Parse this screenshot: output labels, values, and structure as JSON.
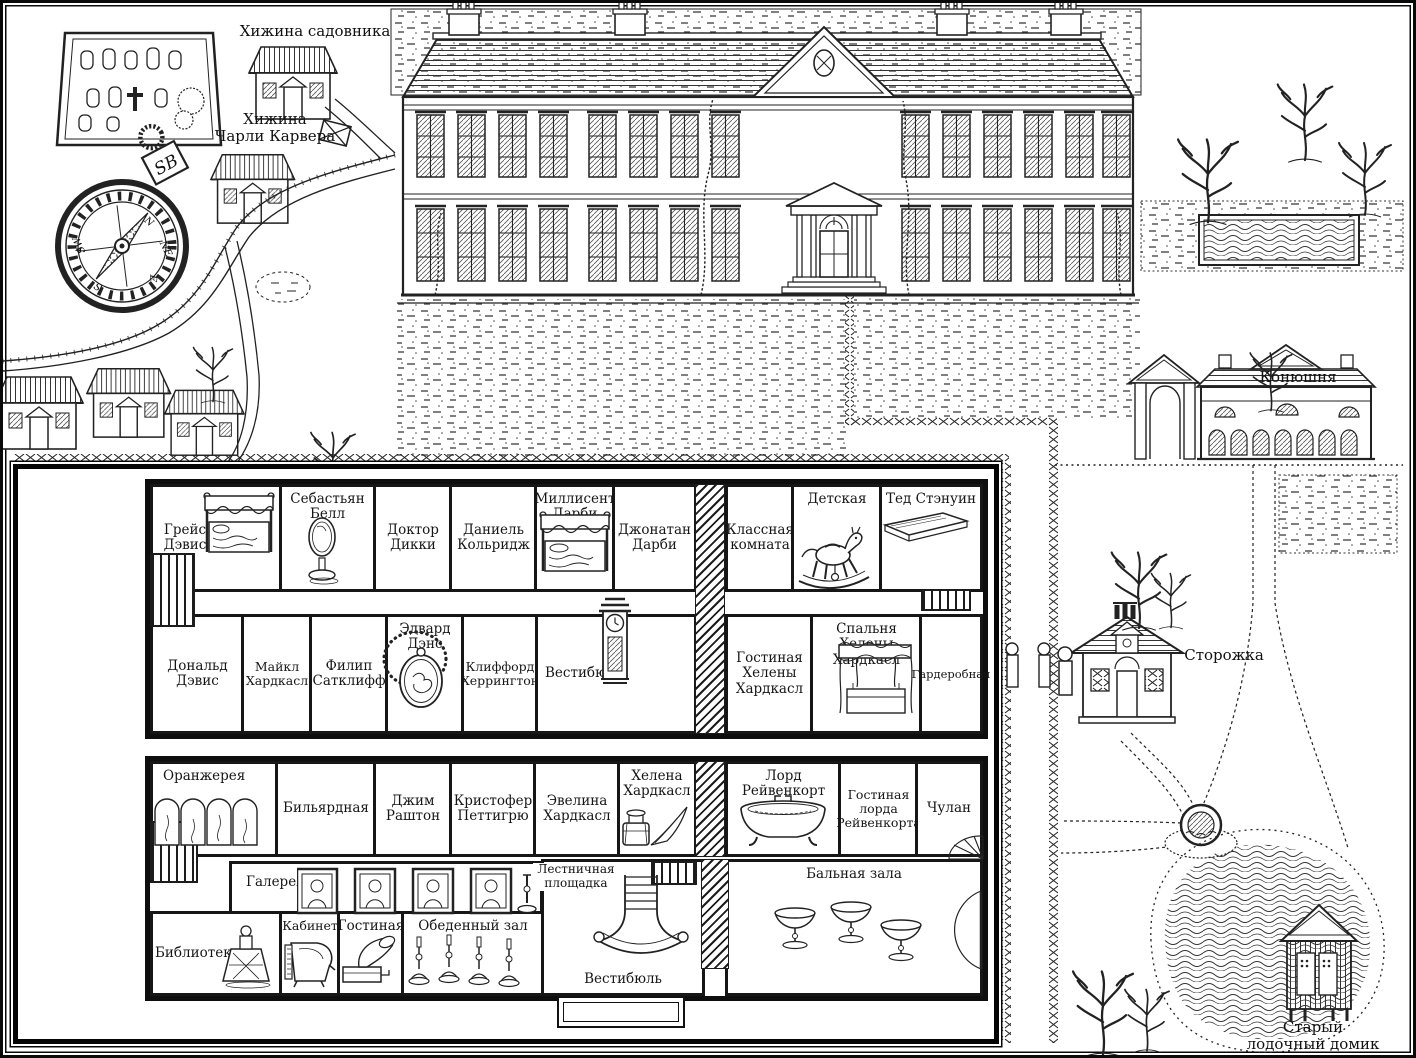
{
  "outdoor": {
    "labels": {
      "gardener_hut": "Хижина садовника",
      "carver_hut": [
        "Хижина",
        "Чарли Карвера"
      ],
      "stable": "Конюшня",
      "lodge": "Сторожка",
      "boathouse": [
        "Старый",
        "лодочный домик"
      ]
    },
    "compass": {
      "monogram": "SB",
      "n": "N",
      "ne": "NE",
      "e": "E",
      "s": "S",
      "sw": "SW"
    }
  },
  "upper_floor": {
    "top_rooms": [
      {
        "label": "Грейс Дэвис",
        "item": "four-poster-bed"
      },
      {
        "label": "Себастьян Белл",
        "item": "cheval-mirror"
      },
      {
        "label": "Доктор Дикки",
        "item": ""
      },
      {
        "label": "Даниель Кольридж",
        "item": ""
      },
      {
        "label": "Миллисент Дарби",
        "item": "four-poster-bed"
      },
      {
        "label": "Джонатан Дарби",
        "item": ""
      },
      {
        "label": "Классная комната",
        "item": ""
      },
      {
        "label": "Детская",
        "item": "rocking-horse"
      },
      {
        "label": "Тед Стэнуин",
        "item": "book"
      }
    ],
    "bottom_rooms": [
      {
        "label": "Дональд Дэвис",
        "item": ""
      },
      {
        "label": "Майкл Хардкасл",
        "item": ""
      },
      {
        "label": "Филип Сатклифф",
        "item": ""
      },
      {
        "label": "Эдвард Дэнс",
        "item": "locket"
      },
      {
        "label": "Клиффорд Херрингтон",
        "item": ""
      },
      {
        "label": "Вестибюль",
        "item": "grandfather-clock"
      },
      {
        "label": "Гостиная Хелены Хардкасл",
        "item": ""
      },
      {
        "label": "Спальня Хелены Хардкасл",
        "item": "canopy-bed"
      },
      {
        "label": "Гардеробная",
        "item": ""
      }
    ]
  },
  "ground_floor": {
    "top_rooms": [
      {
        "label": "Оранжерея",
        "item": "folding-screen"
      },
      {
        "label": "Бильярдная",
        "item": ""
      },
      {
        "label": "Джим Раштон",
        "item": ""
      },
      {
        "label": "Кристофер Петтигрю",
        "item": ""
      },
      {
        "label": "Эвелина Хардкасл",
        "item": ""
      },
      {
        "label": "Хелена Хардкасл",
        "item": "inkwell-and-quill"
      },
      {
        "label": "Лорд Рейвенкорт",
        "item": "bathtub"
      },
      {
        "label": "Гостиная лорда Рейвенкорта",
        "item": ""
      },
      {
        "label": "Чулан",
        "item": ""
      }
    ],
    "bottom_rooms": [
      {
        "label": "Библиотека",
        "item": "decanter"
      },
      {
        "label": "Галерея",
        "item": "portraits"
      },
      {
        "label": "Кабинет",
        "item": "piano"
      },
      {
        "label": "Гостиная",
        "item": "gramophone"
      },
      {
        "label": "Обеденный зал",
        "item": "candlesticks"
      },
      {
        "label": "Лестничная площадка",
        "item": ""
      },
      {
        "label": "Вестибюль",
        "item": "grand-staircase"
      },
      {
        "label": "Бальная зала",
        "item": "champagne-coupes"
      }
    ]
  }
}
